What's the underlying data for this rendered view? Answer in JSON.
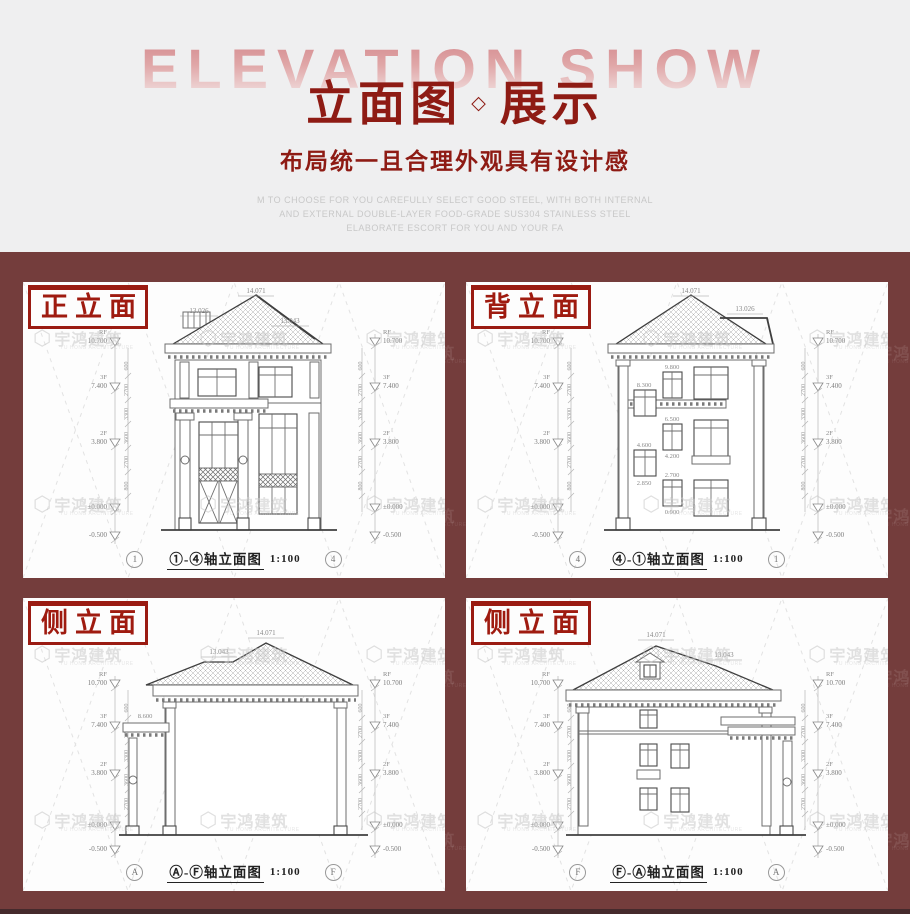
{
  "header": {
    "watermark": "ELEVATION SHOW",
    "title_part1": "立面图",
    "title_separator": "◇",
    "title_part2": "展示",
    "subtitle": "布局统一且合理外观具有设计感",
    "desc_lines": [
      "M TO CHOOSE FOR YOU CAREFULLY SELECT GOOD STEEL, WITH BOTH INTERNAL",
      "AND EXTERNAL DOUBLE-LAYER FOOD-GRADE SUS304 STAINLESS STEEL",
      "ELABORATE ESCORT FOR YOU AND YOUR FA"
    ]
  },
  "colors": {
    "accent_red": "#8e1b14",
    "label_red": "#9a1b12",
    "band_maroon": "#743d3c",
    "hero_bg": "#efeff0",
    "watermark_gray": "#c9c9c9"
  },
  "watermark": {
    "logo_glyph": "⬡",
    "name": "宇鸿建筑",
    "sub": "YU HONG ARCHITECTURE"
  },
  "drawing": {
    "levels": [
      {
        "tag": "RF",
        "value": "10.700"
      },
      {
        "tag": "3F",
        "value": "7.400"
      },
      {
        "tag": "2F",
        "value": "3.800"
      },
      {
        "tag": "",
        "value": "±0.000"
      },
      {
        "tag": "",
        "value": "-0.500"
      }
    ],
    "chain": [
      "600",
      "2700",
      "3300",
      "3600",
      "2700",
      "800"
    ]
  },
  "panels": [
    {
      "label": "正立面",
      "axis_left": "1",
      "axis_right": "4",
      "caption": "①-④轴立面图",
      "scale": "1:100",
      "dims": {
        "apex": "14.071",
        "left": "13.026",
        "right": "13.043"
      }
    },
    {
      "label": "背立面",
      "axis_left": "4",
      "axis_right": "1",
      "caption": "④-①轴立面图",
      "scale": "1:100",
      "dims": {
        "apex": "14.071",
        "right": "13.026"
      },
      "annos": [
        "9.800",
        "8.300",
        "6.500",
        "4.600",
        "4.200",
        "2.850",
        "2.700",
        "0.900"
      ]
    },
    {
      "label": "侧立面",
      "axis_left": "A",
      "axis_right": "F",
      "caption": "Ⓐ-Ⓕ轴立面图",
      "scale": "1:100",
      "dims": {
        "apex": "14.071",
        "left": "13.043"
      },
      "annos": [
        "8.600"
      ]
    },
    {
      "label": "侧立面",
      "axis_left": "F",
      "axis_right": "A",
      "caption": "Ⓕ-Ⓐ轴立面图",
      "scale": "1:100",
      "dims": {
        "apex": "14.071",
        "right": "13.043"
      }
    }
  ]
}
